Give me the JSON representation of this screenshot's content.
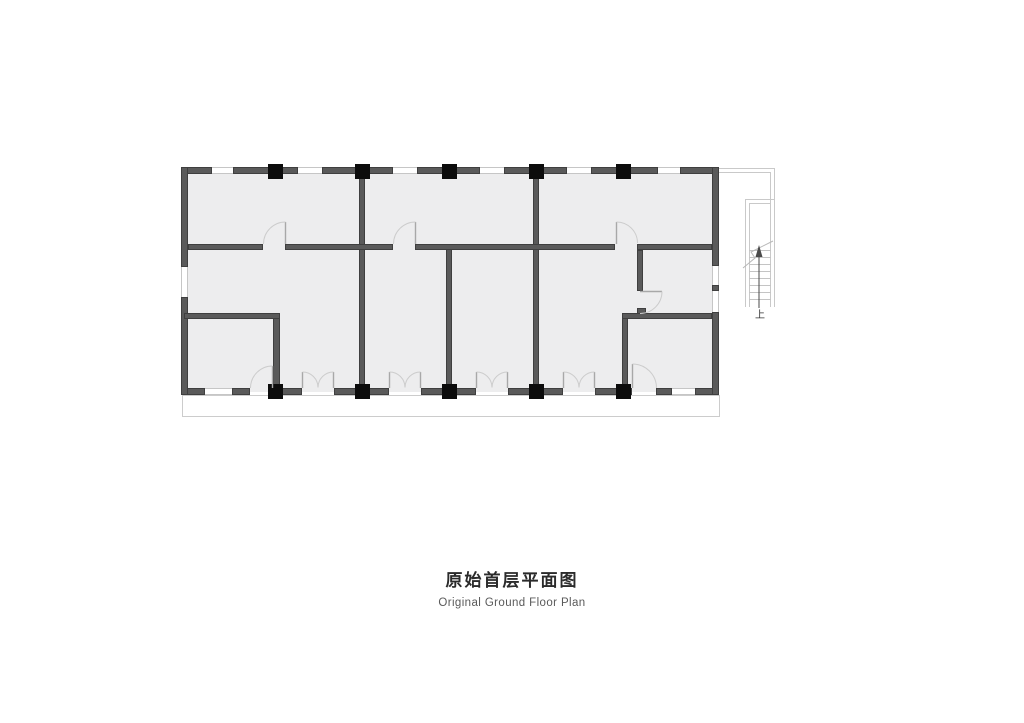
{
  "caption": {
    "title_zh": "原始首层平面图",
    "title_en": "Original Ground Floor Plan"
  },
  "stair": {
    "up_label": "上",
    "icons": [
      "up-arrow-icon",
      "stair-break-line-icon"
    ],
    "treads_count": 8
  },
  "colors": {
    "background": "#ffffff",
    "wall": "#5a5a5a",
    "wall_edge": "#3f3f3f",
    "room_fill": "#ededee",
    "column": "#0c0c0c",
    "light_line": "#c9c9c9",
    "door_arc": "#cccccc",
    "door_leaf": "#a8a8a8",
    "title": "#2b2b2b",
    "subtitle": "#5a5a5a"
  }
}
